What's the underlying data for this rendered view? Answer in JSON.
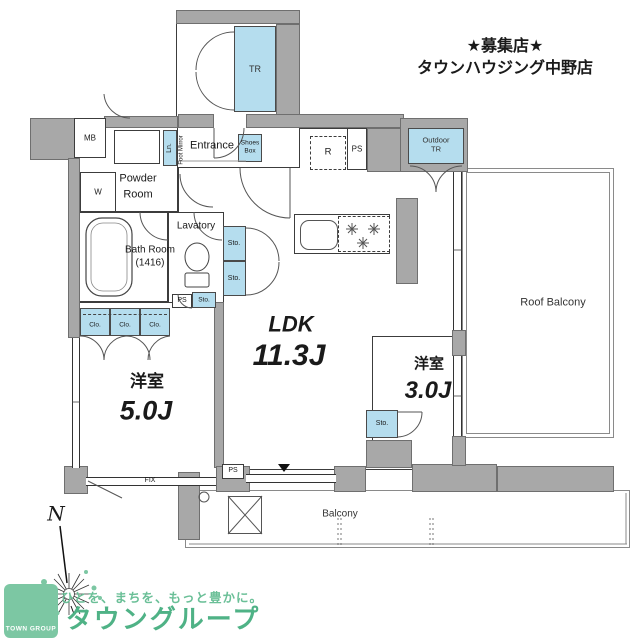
{
  "header": {
    "line1": "★募集店★",
    "line2": "タウンハウジング中野店"
  },
  "rooms": {
    "ldk": {
      "name": "LDK",
      "size": "11.3J"
    },
    "bedroom_west": {
      "name": "洋室",
      "size": "5.0J"
    },
    "bedroom_east": {
      "name": "洋室",
      "size": "3.0J"
    },
    "bath": {
      "line1": "Bath Room",
      "line2": "(1416)"
    },
    "powder": {
      "line1": "Powder",
      "line2": "Room"
    },
    "lavatory": {
      "name": "Lavatory"
    },
    "entrance": {
      "name": "Entrance"
    },
    "balcony": {
      "name": "Balcony"
    },
    "roof_balcony": {
      "name": "Roof Balcony"
    }
  },
  "labels": {
    "tr": "TR",
    "outdoor_tr_line1": "Outdoor",
    "outdoor_tr_line2": "TR",
    "mb": "MB",
    "w": "W",
    "r": "R",
    "ps": "PS",
    "sto": "Sto.",
    "clo": "Clo.",
    "ln": "Ln.",
    "shoes_line1": "Shoes",
    "shoes_line2": "Box",
    "foot_mirror": "Foot Mirror",
    "fix": "FIX",
    "north": "N"
  },
  "logo": {
    "badge": "TOWN GROUP",
    "tagline": "ひとを、まちを、もっと豊かに。",
    "brand": "タウングループ"
  },
  "colors": {
    "wall": "#a8a8a8",
    "storage_blue": "#b5ddee",
    "logo_green": "#7cc7a3",
    "brand_green": "#4fb286"
  }
}
